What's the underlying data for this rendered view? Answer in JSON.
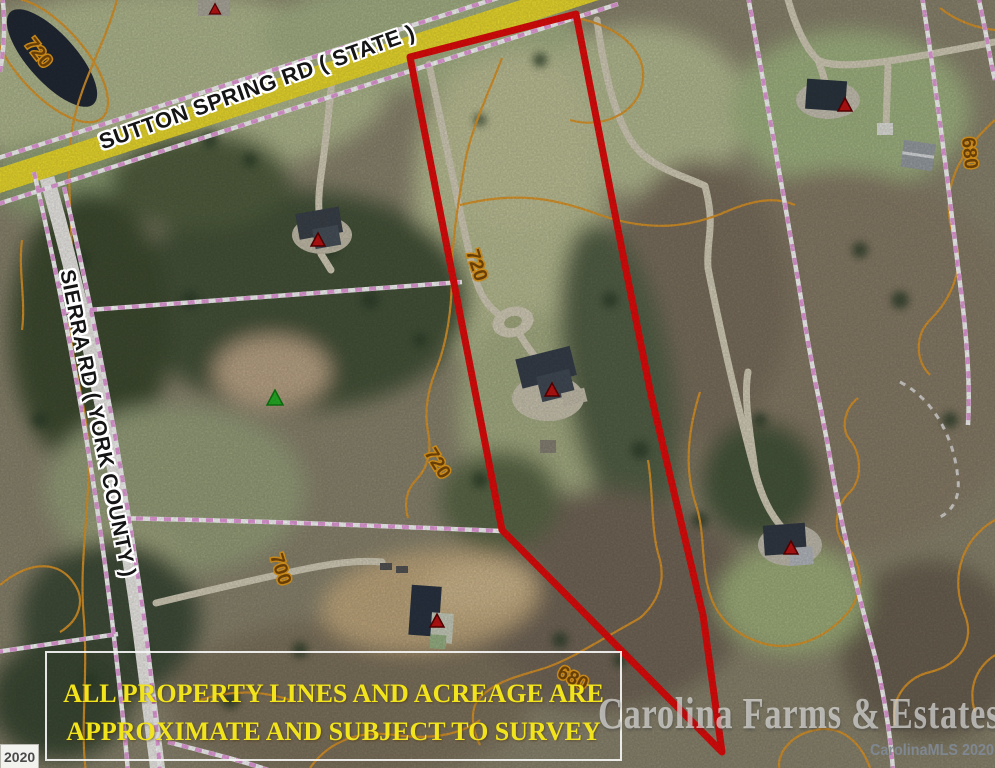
{
  "map": {
    "roads": [
      {
        "name": "sutton-spring-rd",
        "label": "SUTTON SPRING RD ( STATE )"
      },
      {
        "name": "sierra-rd",
        "label": "SIERRA RD ( YORK COUNTY )"
      }
    ],
    "contour_labels": [
      {
        "value": "720"
      },
      {
        "value": "720"
      },
      {
        "value": "720"
      },
      {
        "value": "700"
      },
      {
        "value": "680"
      },
      {
        "value": "680"
      }
    ],
    "disclaimer": {
      "line1": "ALL PROPERTY LINES AND ACREAGE ARE",
      "line2": "APPROXIMATE AND SUBJECT TO SURVEY"
    },
    "watermark": "Carolina Farms & Estates",
    "mls_credit": "CarolinaMLS 2020",
    "corner_year": "2020",
    "colors": {
      "boundary_red": "#e80c0c",
      "road_yellow": "#f2e12f",
      "contour_orange": "#e2992a",
      "property_line_pink": "#eda2e2",
      "disclaimer_yellow": "#f2e41c"
    }
  }
}
